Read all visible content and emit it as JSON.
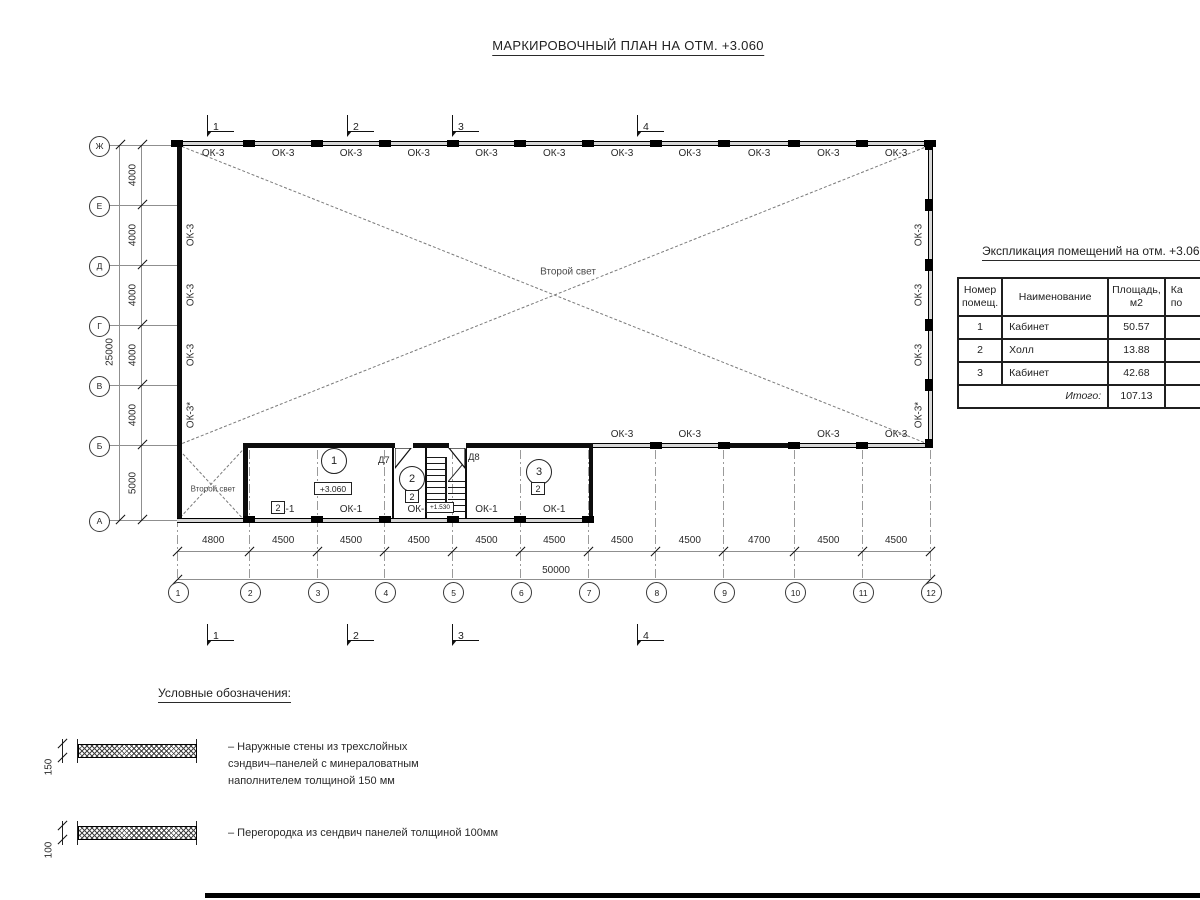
{
  "title": "МАРКИРОВОЧНЫЙ ПЛАН НА ОТМ. +3.060",
  "plan": {
    "col_axes": {
      "labels": [
        "1",
        "2",
        "3",
        "4",
        "5",
        "6",
        "7",
        "8",
        "9",
        "10",
        "11",
        "12"
      ],
      "spacings_mm": [
        4800,
        4500,
        4500,
        4500,
        4500,
        4500,
        4500,
        4500,
        4700,
        4500,
        4500
      ],
      "total": "50000"
    },
    "row_axes": {
      "labels": [
        "Ж",
        "Е",
        "Д",
        "Г",
        "В",
        "Б",
        "А"
      ],
      "spacings_mm": [
        4000,
        4000,
        4000,
        4000,
        4000,
        5000
      ],
      "total": "25000"
    },
    "section_markers": [
      "1",
      "2",
      "3",
      "4"
    ],
    "top_windows": [
      "ОК-3",
      "ОК-3",
      "ОК-3",
      "ОК-3",
      "ОК-3",
      "ОК-3",
      "ОК-3",
      "ОК-3",
      "ОК-3",
      "ОК-3",
      "ОК-3"
    ],
    "left_windows": [
      "ОК-3",
      "ОК-3",
      "ОК-3",
      "ОК-3*"
    ],
    "right_windows": [
      "ОК-3",
      "ОК-3",
      "ОК-3",
      "ОК-3*"
    ],
    "b_wall_windows": [
      "ОК-3",
      "ОК-3",
      "ОК-3",
      "ОК-3"
    ],
    "ok1_windows": [
      "ОК-1",
      "ОК-1",
      "ОК-1",
      "ОК-1",
      "ОК-1"
    ],
    "second_light_main": "Второй свет",
    "second_light_corner": "Второй свет",
    "rooms": [
      {
        "number": "1",
        "category": "2"
      },
      {
        "number": "2",
        "category": "2"
      },
      {
        "number": "3",
        "category": "2"
      }
    ],
    "doors": [
      "Д7",
      "Д8"
    ],
    "elevation_main": "+3.060",
    "elevation_stair": "+1.530"
  },
  "table": {
    "title": "Экспликация помещений на отм. +3.060",
    "headers": {
      "c1": [
        "Номер",
        "помещ."
      ],
      "c2": "Наименование",
      "c3": [
        "Площадь,",
        "м2"
      ],
      "c4": [
        "Ка",
        "по"
      ]
    },
    "rows": [
      {
        "num": "1",
        "name": "Кабинет",
        "area": "50.57"
      },
      {
        "num": "2",
        "name": "Холл",
        "area": "13.88"
      },
      {
        "num": "3",
        "name": "Кабинет",
        "area": "42.68"
      }
    ],
    "total": {
      "label": "Итого:",
      "value": "107.13"
    }
  },
  "legend": {
    "title": "Условные обозначения:",
    "items": [
      {
        "dim": "150",
        "lines": [
          "– Наружные стены из трехслойных",
          "сэндвич–панелей с минераловатным",
          "наполнителем толщиной 150 мм"
        ]
      },
      {
        "dim": "100",
        "lines": [
          "– Перегородка из сендвич панелей толщиной 100мм"
        ]
      }
    ]
  }
}
